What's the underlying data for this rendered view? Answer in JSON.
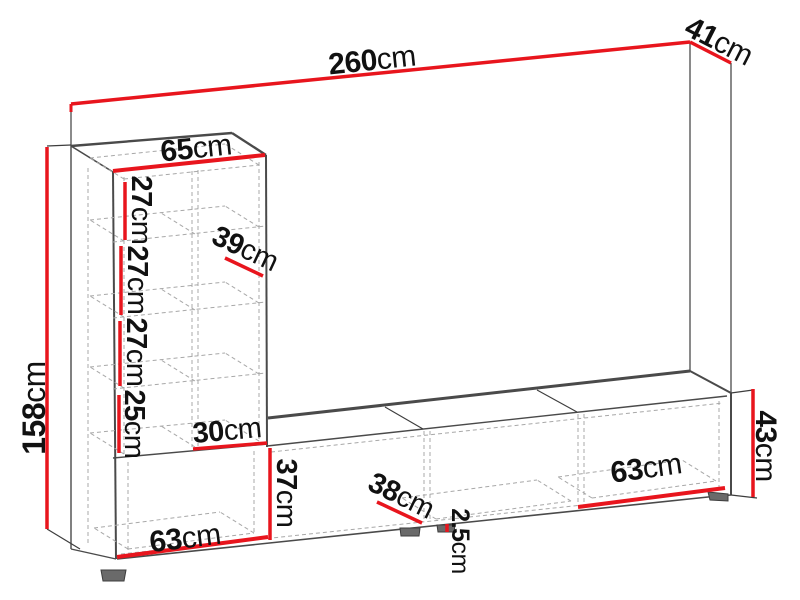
{
  "diagram": {
    "type": "furniture-dimension-diagram",
    "subject": "wall unit: tall open bookshelf column on a long low TV stand, drawn in perspective with red dimension lines",
    "unit": "cm",
    "accent_color": "#e8151d",
    "outline_color": "#4a4a4a",
    "dashed_color": "#a8a8a8",
    "dims": {
      "total_width": {
        "value": "260",
        "unit": "cm"
      },
      "total_depth": {
        "value": "41",
        "unit": "cm"
      },
      "total_height": {
        "value": "158",
        "unit": "cm"
      },
      "column_width": {
        "value": "65",
        "unit": "cm"
      },
      "shelf_gap_1": {
        "value": "27",
        "unit": "cm"
      },
      "shelf_gap_2": {
        "value": "27",
        "unit": "cm"
      },
      "shelf_gap_3": {
        "value": "27",
        "unit": "cm"
      },
      "shelf_gap_4": {
        "value": "25",
        "unit": "cm"
      },
      "shelf_depth": {
        "value": "39",
        "unit": "cm"
      },
      "compartment_width": {
        "value": "30",
        "unit": "cm"
      },
      "left_opening_height": {
        "value": "37",
        "unit": "cm"
      },
      "left_opening_width": {
        "value": "63",
        "unit": "cm"
      },
      "cabinet_depth": {
        "value": "38",
        "unit": "cm"
      },
      "plinth_height": {
        "value": "2.5",
        "unit": "cm"
      },
      "right_opening_width": {
        "value": "63",
        "unit": "cm"
      },
      "tv_stand_height": {
        "value": "43",
        "unit": "cm"
      }
    }
  }
}
